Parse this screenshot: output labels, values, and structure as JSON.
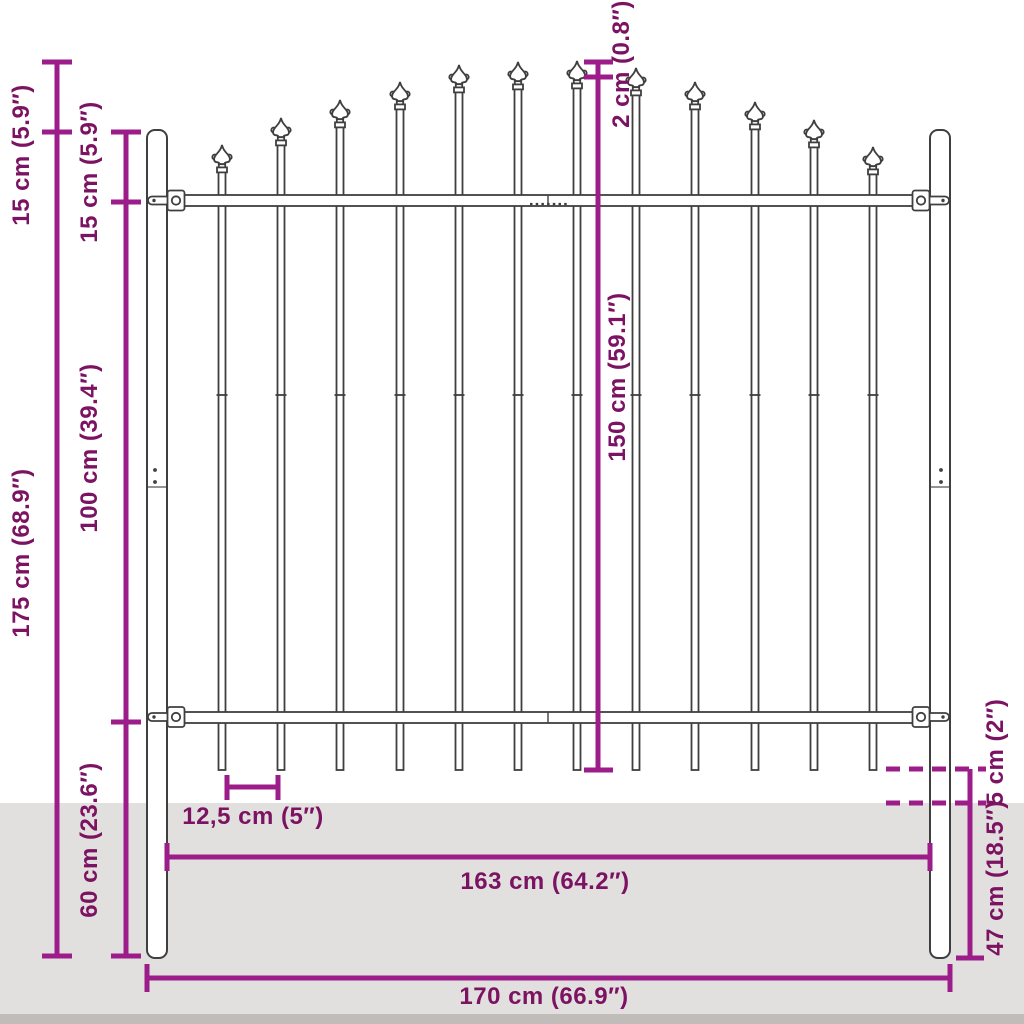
{
  "diagram": {
    "type": "product-dimension-diagram",
    "subject": "steel garden fence panel with spear-top pickets and posts",
    "colors": {
      "dimension_line": "#9c1d8a",
      "dimension_text": "#7c1262",
      "fence_outline": "#3f3f3f",
      "ground": "#e2e0de",
      "ground_edge": "#bfbcb9",
      "background": "#ffffff"
    },
    "dimensions": {
      "spike_height": {
        "label": "15 cm (5.9″)"
      },
      "post_top_to_rail": {
        "label": "15 cm (5.9″)"
      },
      "post_height": {
        "label": "175 cm (68.9″)"
      },
      "rail_spacing": {
        "label": "100 cm (39.4″)"
      },
      "below_rail": {
        "label": "60 cm (23.6″)"
      },
      "spike_step": {
        "label": "2 cm (0.8″)"
      },
      "panel_height": {
        "label": "150 cm (59.1″)"
      },
      "bar_spacing": {
        "label": "12,5 cm (5″)"
      },
      "panel_width": {
        "label": "163 cm (64.2″)"
      },
      "total_width": {
        "label": "170 cm (66.9″)"
      },
      "ground_clearance": {
        "label": "5 cm (2″)"
      },
      "ground_depth": {
        "label": "47 cm (18.5″)"
      }
    }
  }
}
